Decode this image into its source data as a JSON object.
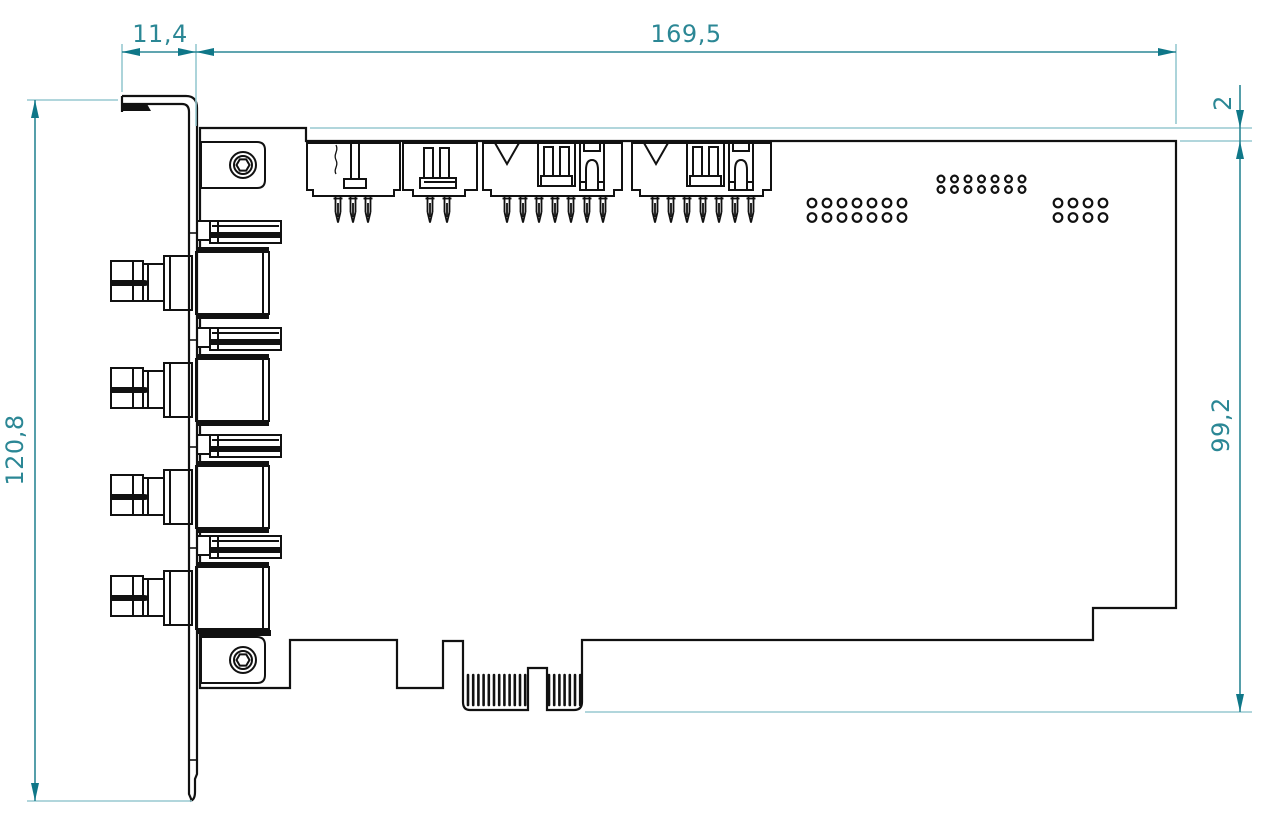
{
  "drawing": {
    "dimensions": {
      "bracket_lip_width": "11,4",
      "board_length": "169,5",
      "top_edge_offset": "2",
      "board_height": "99,2",
      "bracket_height": "120,8"
    },
    "colors": {
      "line": "#111111",
      "dimension": "#2b8795",
      "arrow": "#0f7788",
      "extension": "#97c9d0"
    },
    "components": {
      "bnc_connector_count": 4,
      "bnc_centers_y": [
        283,
        390,
        497,
        598
      ],
      "hole_groups": [
        {
          "cols": 7,
          "rows": 2,
          "x": 812,
          "y": 203,
          "pitch_x": 15,
          "pitch_y": 14.5,
          "r": 4.3
        },
        {
          "cols": 7,
          "rows": 2,
          "x": 941,
          "y": 179,
          "pitch_x": 13.5,
          "pitch_y": 10.5,
          "r": 3.4
        },
        {
          "cols": 4,
          "rows": 2,
          "x": 1058,
          "y": 203,
          "pitch_x": 15,
          "pitch_y": 14.5,
          "r": 4.3
        }
      ],
      "finger_groups": [
        {
          "x": 468,
          "count": 12,
          "pitch": 5.2
        },
        {
          "x": 549,
          "count": 7,
          "pitch": 5.2
        }
      ],
      "pin_rows": [
        {
          "x": 338,
          "count": 3,
          "pitch": 15
        },
        {
          "x": 430,
          "count": 2,
          "pitch": 17
        },
        {
          "x": 507,
          "count": 7,
          "pitch": 16
        },
        {
          "x": 655,
          "count": 7,
          "pitch": 16
        }
      ]
    }
  }
}
